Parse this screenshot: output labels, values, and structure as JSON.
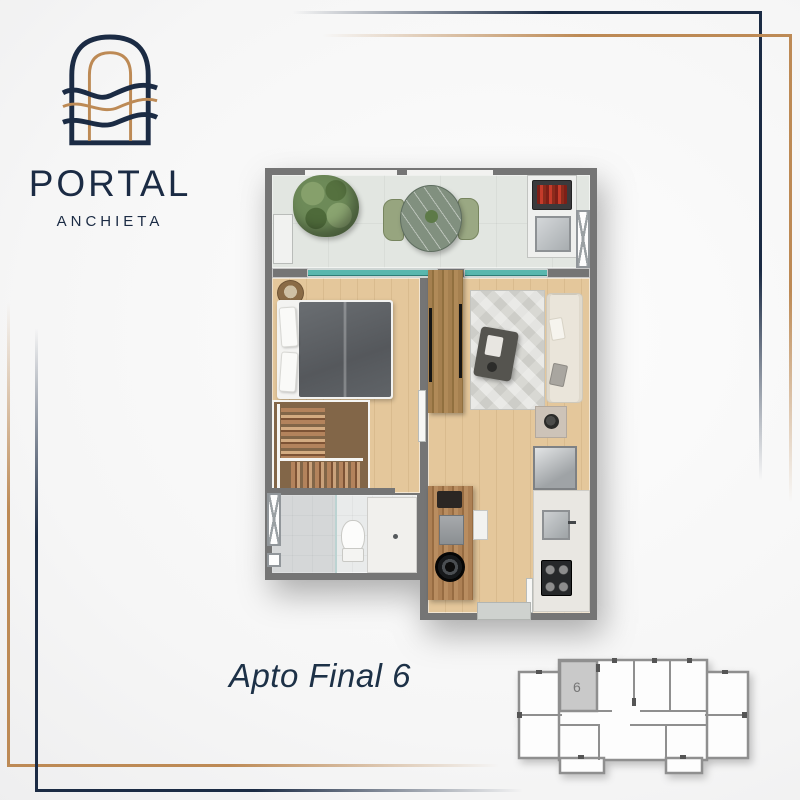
{
  "brand": {
    "name": "PORTAL",
    "subtitle": "ANCHIETA",
    "logo": "arch-with-waves"
  },
  "caption": "Apto Final 6",
  "keyplan": {
    "highlighted_unit": "6",
    "description": "building-floor-key-plan"
  },
  "colors": {
    "navy": "#1b2b44",
    "gold": "#bd8a55",
    "caption": "#1d3147",
    "wall": "#757575",
    "wood": "#e4c79b",
    "woodark": "#ab8357",
    "tile": "#e2e6e1",
    "glass": "#4fb0a8",
    "bath": "#e9ebeb",
    "closet": "#8d6f4e",
    "hl": "#c9c9c9",
    "kpwall": "#8f8f8f"
  },
  "floorplan": {
    "unit": "Apto Final 6",
    "rooms": [
      "balcony",
      "bedroom",
      "closet",
      "bathroom",
      "living-room",
      "kitchen"
    ],
    "furniture": [
      "potted-plant",
      "balcony-bench",
      "round-dining-table",
      "dining-chairs",
      "barbecue-grill",
      "outdoor-sink",
      "utility-shaft",
      "double-bed",
      "pillows",
      "basket-side-table",
      "tv-panel-divider",
      "clothes-rack",
      "toilet",
      "shower",
      "vanity-sink",
      "area-rug",
      "sofa",
      "coffee-table",
      "vase-side-table",
      "refrigerator",
      "kitchen-sink",
      "gas-cooktop",
      "kitchen-island",
      "coffee-machine",
      "washing-machine",
      "doormat"
    ]
  }
}
